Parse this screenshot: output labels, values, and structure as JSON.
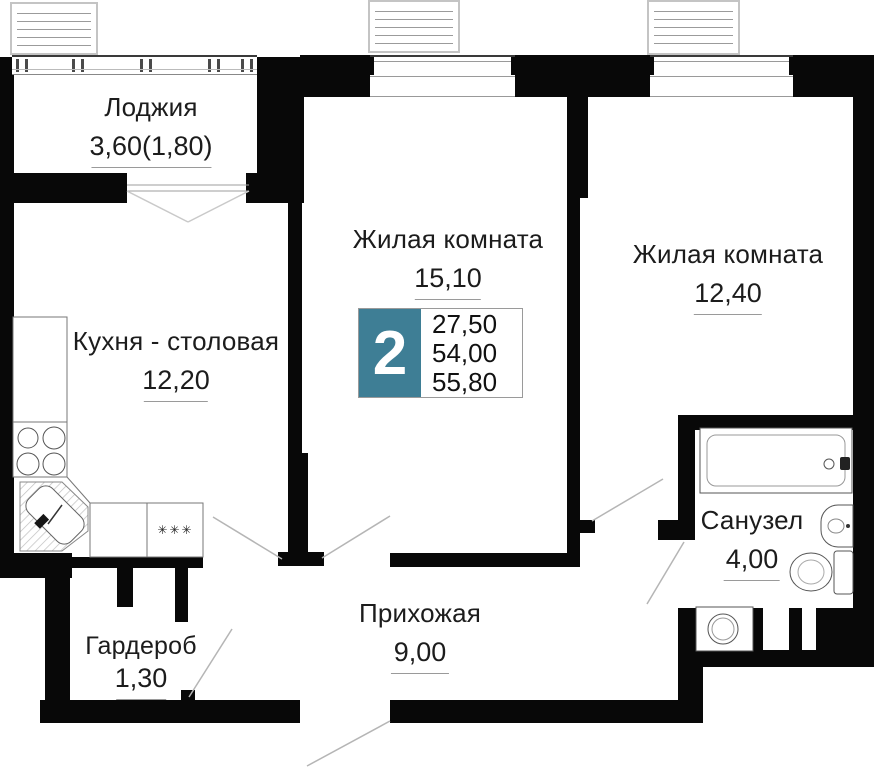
{
  "floorplan": {
    "badge": {
      "rooms_count": "2",
      "area_values": [
        "27,50",
        "54,00",
        "55,80"
      ],
      "accent_color": "#3E7E95"
    },
    "rooms": {
      "loggia": {
        "name": "Лоджия",
        "area": "3,60(1,80)"
      },
      "living1": {
        "name": "Жилая комната",
        "area": "15,10"
      },
      "living2": {
        "name": "Жилая комната",
        "area": "12,40"
      },
      "kitchen": {
        "name": "Кухня - столовая",
        "area": "12,20"
      },
      "bathroom": {
        "name": "Санузел",
        "area": "4,00"
      },
      "hallway": {
        "name": "Прихожая",
        "area": "9,00"
      },
      "wardrobe": {
        "name": "Гардероб",
        "area": "1,30"
      }
    },
    "kitchen_marking": "✳✳✳"
  }
}
